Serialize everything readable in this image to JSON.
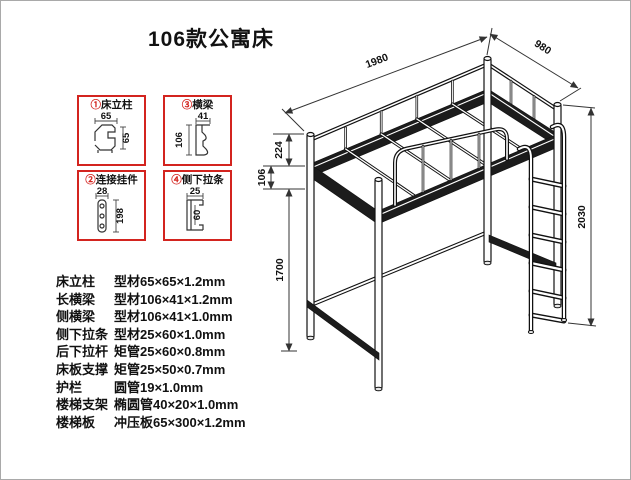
{
  "title": "106款公寓床",
  "detail_boxes": [
    {
      "num": "①",
      "label": "床立柱",
      "dim_top": "65",
      "dim_side": "65"
    },
    {
      "num": "③",
      "label": "横梁",
      "dim_top": "41",
      "dim_side": "106"
    },
    {
      "num": "②",
      "label": "连接挂件",
      "dim_top": "28",
      "dim_side": "198"
    },
    {
      "num": "④",
      "label": "侧下拉条",
      "dim_top": "25",
      "dim_side": "60"
    }
  ],
  "specs": {
    "rows": [
      {
        "label": "床立柱",
        "value": "型材65×65×1.2mm"
      },
      {
        "label": "长横梁",
        "value": "型材106×41×1.2mm"
      },
      {
        "label": "侧横梁",
        "value": "型材106×41×1.0mm"
      },
      {
        "label": "侧下拉条",
        "value": "型材25×60×1.0mm"
      },
      {
        "label": "后下拉杆",
        "value": "矩管25×60×0.8mm"
      },
      {
        "label": "床板支撑",
        "value": "矩管25×50×0.7mm"
      },
      {
        "label": "护栏",
        "value": "圆管19×1.0mm"
      },
      {
        "label": "楼梯支架",
        "value": "椭圆管40×20×1.0mm"
      },
      {
        "label": "楼梯板",
        "value": "冲压板65×300×1.2mm"
      }
    ]
  },
  "drawing": {
    "dim_length": "1980",
    "dim_width": "980",
    "dim_height": "2030",
    "dim_clearance": "1700",
    "dim_beam": "106",
    "dim_rail": "224"
  },
  "colors": {
    "accent_red": "#d3241f",
    "line_dark": "#111111"
  }
}
